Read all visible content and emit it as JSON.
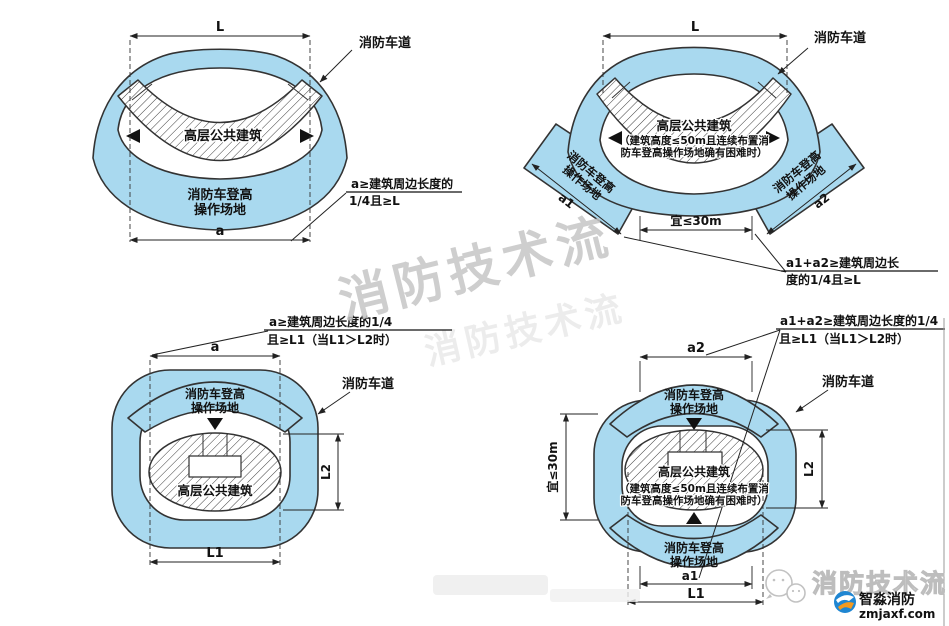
{
  "colors": {
    "area": "#a9d9ef",
    "outline": "#333333",
    "dim": "#222222",
    "watermark": "#c6c6c6"
  },
  "watermarks": {
    "diagonal": "消防技术流",
    "diagonal2": "消防技术流",
    "outline_text": "消防技术流",
    "brand_name": "智淼消防",
    "brand_site": "zmjaxf.com"
  },
  "panels": {
    "p1": {
      "dim_L": "L",
      "dim_a": "a",
      "fire_lane": "消防车道",
      "building": "高层公共建筑",
      "op1": "消防车登高",
      "op2": "操作场地",
      "note1": "a≥建筑周边长度的",
      "note2": "1/4且≥L"
    },
    "p2": {
      "dim_L": "L",
      "dim_a1": "a1",
      "dim_a2": "a2",
      "dim_gap": "宜≤30m",
      "fire_lane": "消防车道",
      "building": "高层公共建筑",
      "bnote1": "（建筑高度≤50m且连续布置消",
      "bnote2": "防车登高操作场地确有困难时）",
      "op1": "消防车登高",
      "op2": "操作场地",
      "note1": "a1+a2≥建筑周边长",
      "note2": "度的1/4且≥L"
    },
    "p3": {
      "dim_a": "a",
      "dim_L1": "L1",
      "dim_L2": "L2",
      "fire_lane": "消防车道",
      "building": "高层公共建筑",
      "op1": "消防车登高",
      "op2": "操作场地",
      "note1": "a≥建筑周边长度的1/4",
      "note2": "且≥L1（当L1＞L2时）"
    },
    "p4": {
      "dim_a1": "a1",
      "dim_a2": "a2",
      "dim_L1": "L1",
      "dim_L2": "L2",
      "dim_gap": "宜≤30m",
      "fire_lane": "消防车道",
      "building": "高层公共建筑",
      "bnote1": "（建筑高度≤50m且连续布置消",
      "bnote2": "防车登高操作场地确有困难时）",
      "op_top1": "消防车登高",
      "op_top2": "操作场地",
      "op_bot1": "消防车登高",
      "op_bot2": "操作场地",
      "note1": "a1+a2≥建筑周边长度的1/4",
      "note2": "且≥L1（当L1＞L2时）"
    }
  }
}
